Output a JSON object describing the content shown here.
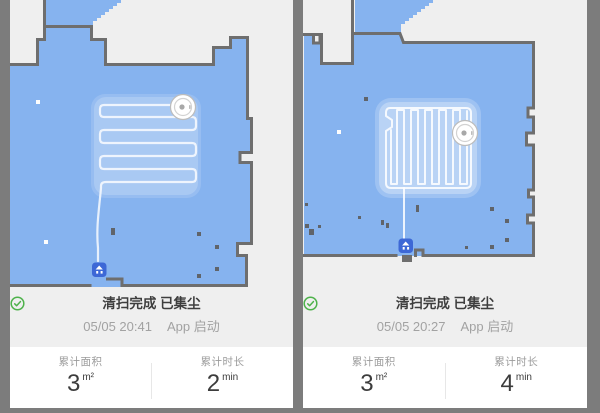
{
  "colors": {
    "frame": "#7c7c7c",
    "panel_background": "#efefef",
    "map_fill": "#86b3ef",
    "wall": "#6e6e6e",
    "clean_path": "#ffffff",
    "dock_blue": "#3d68d6",
    "accent_green": "#4db24a",
    "title_text": "#3e3e3e",
    "secondary_text": "#a2a2a2",
    "stat_value_text": "#3c3c3c"
  },
  "panels": [
    {
      "status": {
        "icon": "check-circle-icon",
        "title": "清扫完成 已集尘",
        "time": "05/05 20:41",
        "trigger": "App 启动"
      },
      "stats": [
        {
          "label": "累计面积",
          "value": "3",
          "unit": "m²"
        },
        {
          "label": "累计时长",
          "value": "2",
          "unit": "min"
        }
      ]
    },
    {
      "status": {
        "icon": "check-circle-icon",
        "title": "清扫完成 已集尘",
        "time": "05/05 20:27",
        "trigger": "App 启动"
      },
      "stats": [
        {
          "label": "累计面积",
          "value": "3",
          "unit": "m²"
        },
        {
          "label": "累计时长",
          "value": "4",
          "unit": "min"
        }
      ]
    }
  ]
}
